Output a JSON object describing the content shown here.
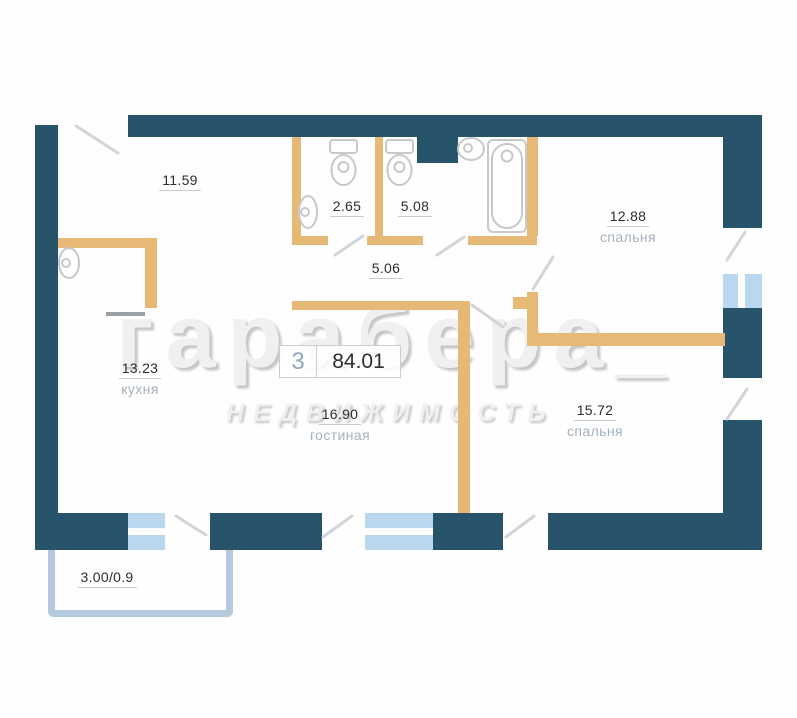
{
  "badge": {
    "room_count": "3",
    "total_area": "84.01"
  },
  "rooms": {
    "hall": {
      "area": "11.59"
    },
    "wc": {
      "area": "2.65"
    },
    "bath": {
      "area": "5.08"
    },
    "bedroom1": {
      "area": "12.88",
      "name": "спальня"
    },
    "corridor": {
      "area": "5.06"
    },
    "kitchen": {
      "area": "13.23",
      "name": "кухня"
    },
    "living": {
      "area": "16.90",
      "name": "гостиная"
    },
    "bedroom2": {
      "area": "15.72",
      "name": "спальня"
    },
    "balcony": {
      "area": "3.00/0.9"
    }
  },
  "watermark": {
    "line1": "гарабера_",
    "line2": "НЕДВИЖИМОСТЬ"
  },
  "icons": [
    "toilet-icon",
    "toilet-icon",
    "wall-sink-icon",
    "bath-sink-icon",
    "bathtub-icon",
    "kitchen-sink-icon"
  ],
  "colors": {
    "wall_dark": "#27536b",
    "wall_tan": "#e6ba76",
    "window_blue": "#b9d8f0",
    "balcony": "#b4c9dc",
    "door_line": "#d0d5da",
    "leaf_gray": "#9aa0a5",
    "fixture": "#c6c8ca",
    "num_color": "#2e2e2e",
    "name_color": "#a5b1bd",
    "underline": "#c8cdd3",
    "badge_border": "#c5ced5",
    "badge_rooms_color": "#8da8c0",
    "watermark_color": "#f0f0f0",
    "watermark_shadow": "#c6c6c6"
  }
}
